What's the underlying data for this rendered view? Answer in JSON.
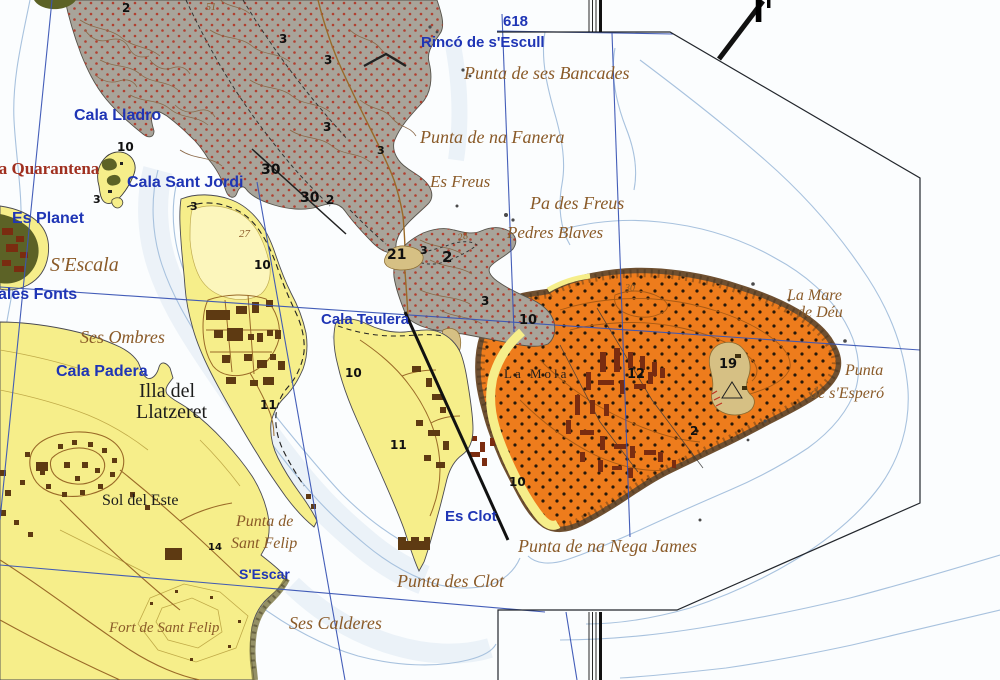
{
  "map_kind": "topographic coastal map extract",
  "colors": {
    "water": "#fbfdfe",
    "water_shallow": "#e3edf5",
    "bathy_line": "#a8c2de",
    "grid_blue": "#3a55b5",
    "neatline": "#22262c",
    "land_yellow": "#f6ee8a",
    "land_yellow_pale": "#fcf6bc",
    "land_gray": "#a8a49a",
    "land_orange": "#ee7c1c",
    "rock_fringe": "#6e4f30",
    "tan_patch": "#d6c084",
    "green_dark": "#5c6226",
    "dot_red": "#b04030",
    "contour_brown": "#8a6848",
    "contour_olive": "#c0aa48",
    "contour_orange": "#a85a14",
    "road_brown": "#9a6a28",
    "building_brown": "#5e3a12",
    "building_red": "#7a2c10",
    "label_blue": "#1f35b5",
    "label_brown": "#8a5a28",
    "label_red": "#a03020"
  },
  "labels": [
    {
      "id": "label-618",
      "text": "618",
      "x": 503,
      "y": 14,
      "cls": "blue",
      "fs": 15
    },
    {
      "id": "label-rinco-de-s-escull",
      "text": "Rincó de s'Escull",
      "x": 421,
      "y": 35,
      "cls": "blue",
      "fs": 15
    },
    {
      "id": "label-punta-de-ses-bancades",
      "text": "Punta de ses Bancades",
      "x": 464,
      "y": 64,
      "cls": "brown",
      "fs": 18
    },
    {
      "id": "label-punta-de-na-fanera",
      "text": "Punta de na Fanera",
      "x": 420,
      "y": 128,
      "cls": "brown",
      "fs": 18
    },
    {
      "id": "label-es-freus",
      "text": "Es Freus",
      "x": 430,
      "y": 173,
      "cls": "brown",
      "fs": 17
    },
    {
      "id": "label-pa-des-freus",
      "text": "Pa des Freus",
      "x": 530,
      "y": 194,
      "cls": "brown",
      "fs": 18
    },
    {
      "id": "label-pedres-blaves",
      "text": "Pedres Blaves",
      "x": 507,
      "y": 224,
      "cls": "brown",
      "fs": 17
    },
    {
      "id": "label-cala-lladro",
      "text": "Cala Lladro",
      "x": 74,
      "y": 108,
      "cls": "blue",
      "fs": 16
    },
    {
      "id": "label-la-quarantena",
      "text": "la Quarantena",
      "x": -6,
      "y": 160,
      "cls": "red",
      "fs": 17
    },
    {
      "id": "label-cala-sant-jordi",
      "text": "Cala Sant Jordi",
      "x": 127,
      "y": 175,
      "cls": "blue",
      "fs": 16
    },
    {
      "id": "label-es-planet",
      "text": "Es Planet",
      "x": 12,
      "y": 211,
      "cls": "blue",
      "fs": 16
    },
    {
      "id": "label-s-escala",
      "text": "S'Escala",
      "x": 50,
      "y": 255,
      "cls": "brown",
      "fs": 20
    },
    {
      "id": "label-ales-fonts",
      "text": "ales Fonts",
      "x": -2,
      "y": 287,
      "cls": "blue",
      "fs": 16
    },
    {
      "id": "label-ses-ombres",
      "text": "Ses Ombres",
      "x": 80,
      "y": 328,
      "cls": "brown",
      "fs": 18
    },
    {
      "id": "label-cala-padera",
      "text": "Cala Padera",
      "x": 56,
      "y": 364,
      "cls": "blue",
      "fs": 16
    },
    {
      "id": "label-illa-del",
      "text": "Illa del",
      "x": 139,
      "y": 381,
      "cls": "blackserif",
      "fs": 20
    },
    {
      "id": "label-llatzeret",
      "text": "Llatzeret",
      "x": 136,
      "y": 402,
      "cls": "blackserif",
      "fs": 20
    },
    {
      "id": "label-cala-teulera",
      "text": "Cala Teulera",
      "x": 321,
      "y": 312,
      "cls": "blue",
      "fs": 15
    },
    {
      "id": "label-la-mola",
      "text": "La Mola",
      "x": 504,
      "y": 367,
      "cls": "blackserif",
      "fs": 13,
      "ls": 3
    },
    {
      "id": "label-la-mare",
      "text": "La Mare",
      "x": 787,
      "y": 288,
      "cls": "brown",
      "fs": 16
    },
    {
      "id": "label-de-deu",
      "text": "de Déu",
      "x": 797,
      "y": 305,
      "cls": "brown",
      "fs": 16
    },
    {
      "id": "label-punta-de-s-espero-1",
      "text": "Punta",
      "x": 845,
      "y": 363,
      "cls": "brown",
      "fs": 16
    },
    {
      "id": "label-punta-de-s-espero-2",
      "text": "de s'Esperó",
      "x": 810,
      "y": 386,
      "cls": "brown",
      "fs": 16
    },
    {
      "id": "label-sol-del-este",
      "text": "Sol del Este",
      "x": 102,
      "y": 493,
      "cls": "blackserif",
      "fs": 16
    },
    {
      "id": "label-punta-de-sant-felip-1",
      "text": "Punta de",
      "x": 236,
      "y": 514,
      "cls": "brown",
      "fs": 16
    },
    {
      "id": "label-punta-de-sant-felip-2",
      "text": "Sant Felip",
      "x": 231,
      "y": 536,
      "cls": "brown",
      "fs": 16
    },
    {
      "id": "label-s-escar",
      "text": "S'Escar",
      "x": 239,
      "y": 567,
      "cls": "blue",
      "fs": 14
    },
    {
      "id": "label-es-clot",
      "text": "Es Clot",
      "x": 445,
      "y": 509,
      "cls": "blue",
      "fs": 15
    },
    {
      "id": "label-punta-de-na-nega-james",
      "text": "Punta de na Nega James",
      "x": 518,
      "y": 537,
      "cls": "brown",
      "fs": 18
    },
    {
      "id": "label-punta-des-clot",
      "text": "Punta des Clot",
      "x": 397,
      "y": 572,
      "cls": "brown",
      "fs": 18
    },
    {
      "id": "label-ses-calderes",
      "text": "Ses Calderes",
      "x": 289,
      "y": 614,
      "cls": "brown",
      "fs": 18
    },
    {
      "id": "label-fort-de-sant-felip",
      "text": "Fort de Sant Felip",
      "x": 109,
      "y": 621,
      "cls": "brown",
      "fs": 15
    },
    {
      "id": "label-section-i-prime",
      "text": "I'",
      "x": 753,
      "y": -2,
      "cls": "section",
      "fs": 30
    },
    {
      "id": "spot-2-a",
      "text": "2",
      "x": 122,
      "y": 2,
      "cls": "num",
      "fs": 12
    },
    {
      "id": "contour-51",
      "text": "51",
      "x": 206,
      "y": 3,
      "cls": "cnum",
      "fs": 10
    },
    {
      "id": "spot-3-a",
      "text": "3",
      "x": 279,
      "y": 33,
      "cls": "num",
      "fs": 12
    },
    {
      "id": "spot-3-b",
      "text": "3",
      "x": 324,
      "y": 54,
      "cls": "num",
      "fs": 12
    },
    {
      "id": "spot-3-c",
      "text": "3",
      "x": 323,
      "y": 121,
      "cls": "num",
      "fs": 12
    },
    {
      "id": "spot-10-islet",
      "text": "10",
      "x": 117,
      "y": 141,
      "cls": "num",
      "fs": 12
    },
    {
      "id": "spot-3-islet",
      "text": "3",
      "x": 93,
      "y": 194,
      "cls": "num",
      "fs": 11
    },
    {
      "id": "spot-3-island",
      "text": "3",
      "x": 190,
      "y": 201,
      "cls": "num",
      "fs": 11
    },
    {
      "id": "spot-30-a",
      "text": "30",
      "x": 261,
      "y": 163,
      "cls": "num",
      "fs": 14
    },
    {
      "id": "spot-30-b",
      "text": "30",
      "x": 300,
      "y": 191,
      "cls": "num",
      "fs": 14
    },
    {
      "id": "spot-2-b",
      "text": "2",
      "x": 326,
      "y": 194,
      "cls": "num",
      "fs": 12
    },
    {
      "id": "spot-3-fanera",
      "text": "3",
      "x": 377,
      "y": 145,
      "cls": "num",
      "fs": 11
    },
    {
      "id": "contour-27",
      "text": "27",
      "x": 239,
      "y": 229,
      "cls": "cnum",
      "fs": 11
    },
    {
      "id": "spot-10-island",
      "text": "10",
      "x": 254,
      "y": 259,
      "cls": "num",
      "fs": 12
    },
    {
      "id": "spot-21",
      "text": "21",
      "x": 387,
      "y": 248,
      "cls": "num",
      "fs": 14
    },
    {
      "id": "spot-3-d",
      "text": "3",
      "x": 420,
      "y": 245,
      "cls": "num",
      "fs": 11
    },
    {
      "id": "spot-2-c",
      "text": "2",
      "x": 442,
      "y": 250,
      "cls": "num",
      "fs": 15
    },
    {
      "id": "contour-28",
      "text": "28",
      "x": 457,
      "y": 234,
      "cls": "cnum",
      "fs": 10,
      "rot": -15
    },
    {
      "id": "spot-3-e",
      "text": "3",
      "x": 481,
      "y": 295,
      "cls": "num",
      "fs": 12
    },
    {
      "id": "spot-10-mola-nw",
      "text": "10",
      "x": 519,
      "y": 314,
      "cls": "num",
      "fs": 13
    },
    {
      "id": "contour-30-mola",
      "text": "30",
      "x": 625,
      "y": 284,
      "cls": "cnum",
      "fs": 10
    },
    {
      "id": "spot-12",
      "text": "12",
      "x": 627,
      "y": 368,
      "cls": "num",
      "fs": 13
    },
    {
      "id": "spot-19",
      "text": "19",
      "x": 719,
      "y": 358,
      "cls": "num",
      "fs": 13
    },
    {
      "id": "spot-11-island",
      "text": "11",
      "x": 260,
      "y": 399,
      "cls": "num",
      "fs": 12
    },
    {
      "id": "spot-10-peninsula",
      "text": "10",
      "x": 345,
      "y": 367,
      "cls": "num",
      "fs": 12
    },
    {
      "id": "spot-11-peninsula",
      "text": "11",
      "x": 390,
      "y": 439,
      "cls": "num",
      "fs": 12
    },
    {
      "id": "spot-10-mola-s",
      "text": "10",
      "x": 509,
      "y": 476,
      "cls": "num",
      "fs": 12
    },
    {
      "id": "spot-2-mola",
      "text": "2",
      "x": 690,
      "y": 425,
      "cls": "num",
      "fs": 12
    },
    {
      "id": "spot-14",
      "text": "14",
      "x": 208,
      "y": 543,
      "cls": "num",
      "fs": 10
    }
  ]
}
